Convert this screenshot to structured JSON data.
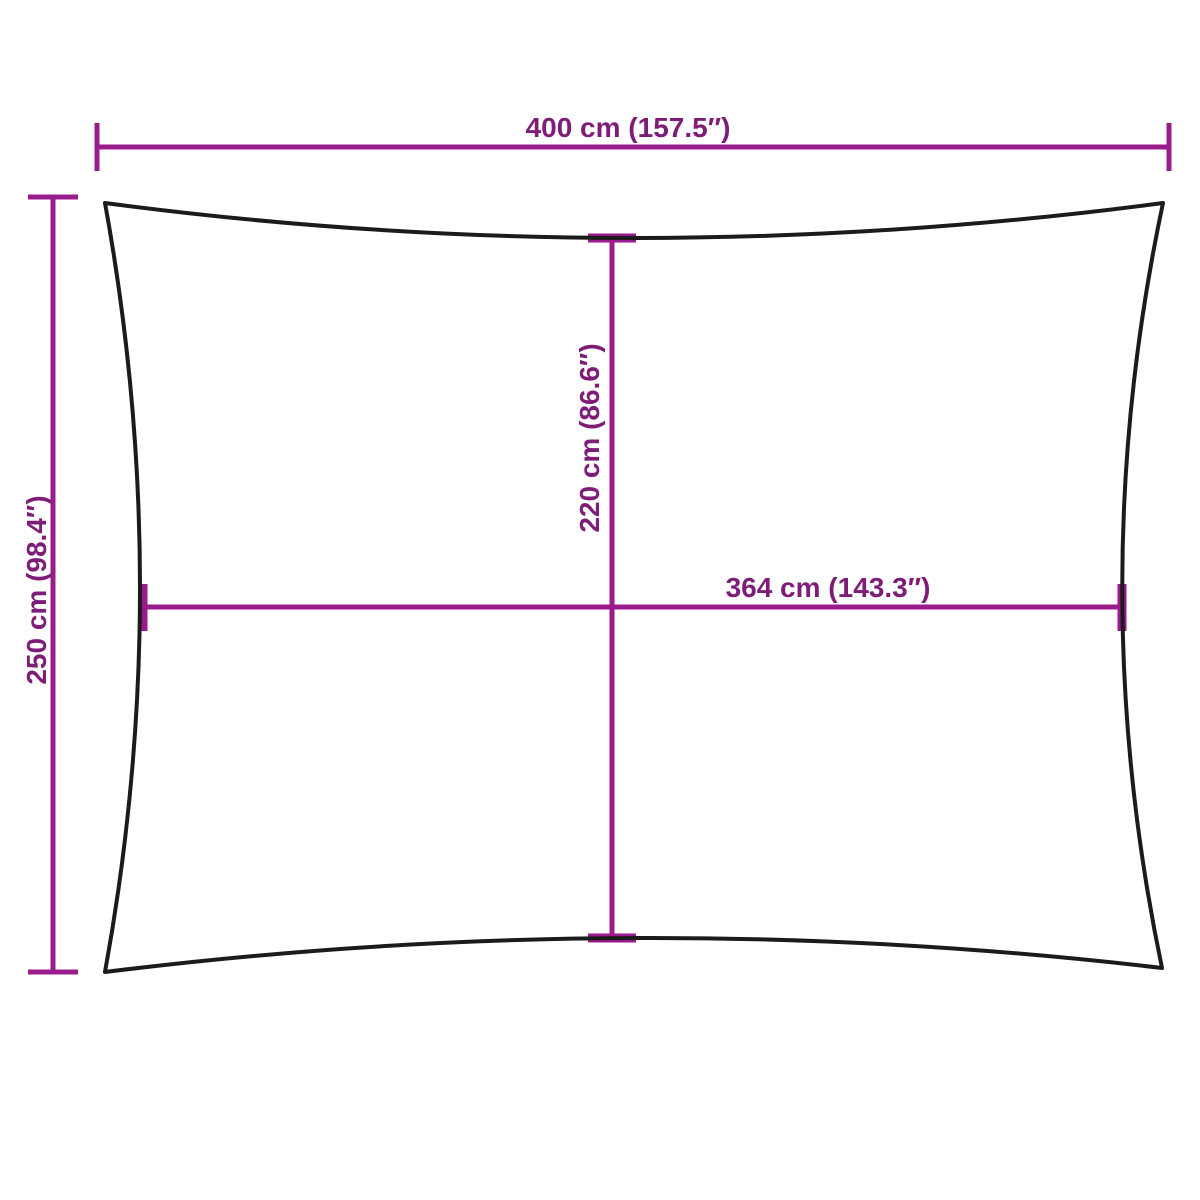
{
  "colors": {
    "background": "#ffffff",
    "dimension_line": "#9a1b8c",
    "dimension_text": "#7d1d78",
    "sail_outline": "#1b1b1b"
  },
  "diagram": {
    "subject": "rectangular shade sail with concave edges",
    "dimensions": {
      "overall_width": {
        "label": "400 cm (157.5″)",
        "cm": 400,
        "inches": 157.5,
        "orientation": "horizontal",
        "position": "top"
      },
      "overall_height": {
        "label": "250 cm (98.4″)",
        "cm": 250,
        "inches": 98.4,
        "orientation": "vertical",
        "position": "left"
      },
      "inner_height": {
        "label": "220 cm (86.6″)",
        "cm": 220,
        "inches": 86.6,
        "orientation": "vertical",
        "position": "center"
      },
      "inner_width": {
        "label": "364 cm (143.3″)",
        "cm": 364,
        "inches": 143.3,
        "orientation": "horizontal",
        "position": "center"
      }
    }
  }
}
